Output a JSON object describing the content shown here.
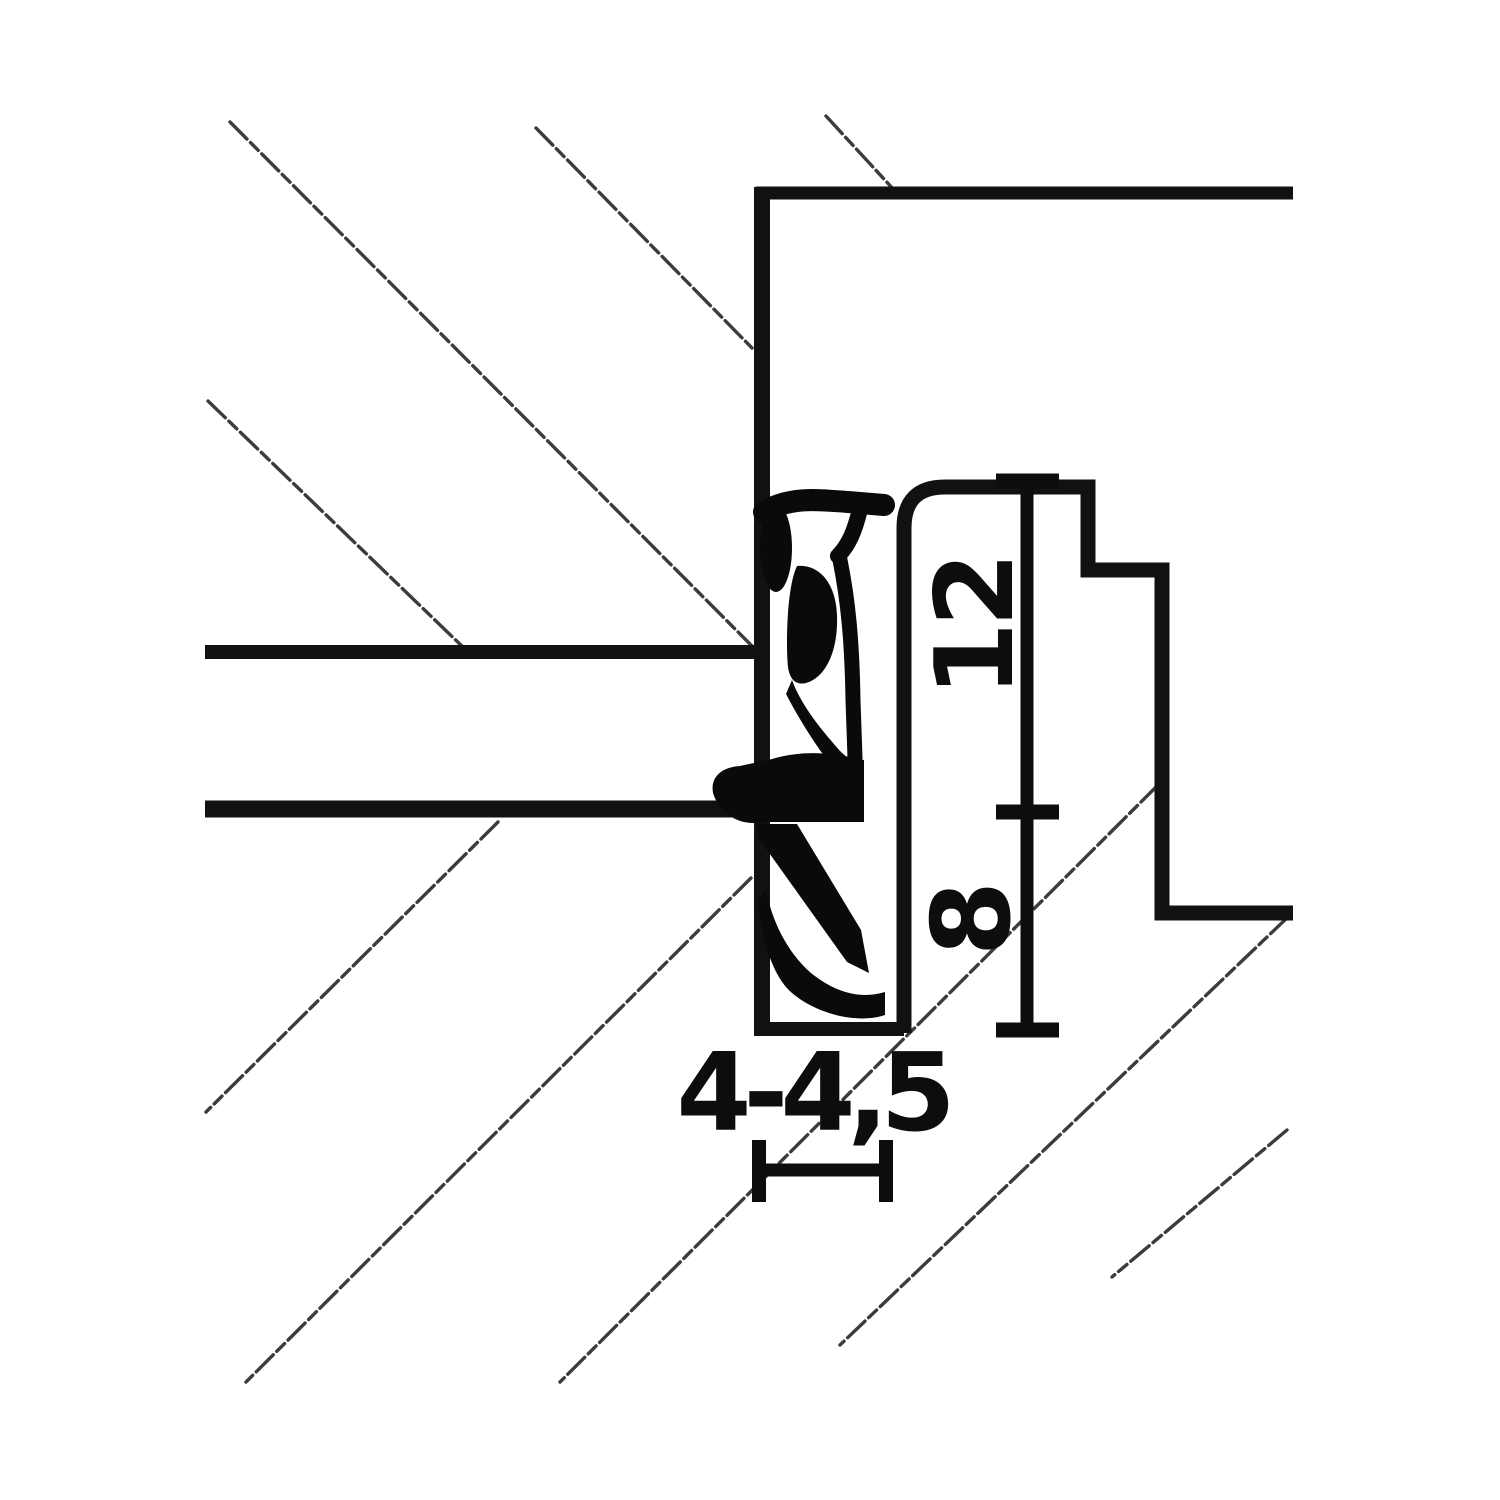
{
  "drawing": {
    "labels": {
      "height_upper": "12",
      "height_lower": "8",
      "width_groove": "4-4,5"
    }
  },
  "colors": {
    "background": "#ffffff",
    "outline": "#111111",
    "hatch": "#3c3c3c",
    "seal": "#0a0a0a",
    "dimension": "#0d0d0d"
  }
}
